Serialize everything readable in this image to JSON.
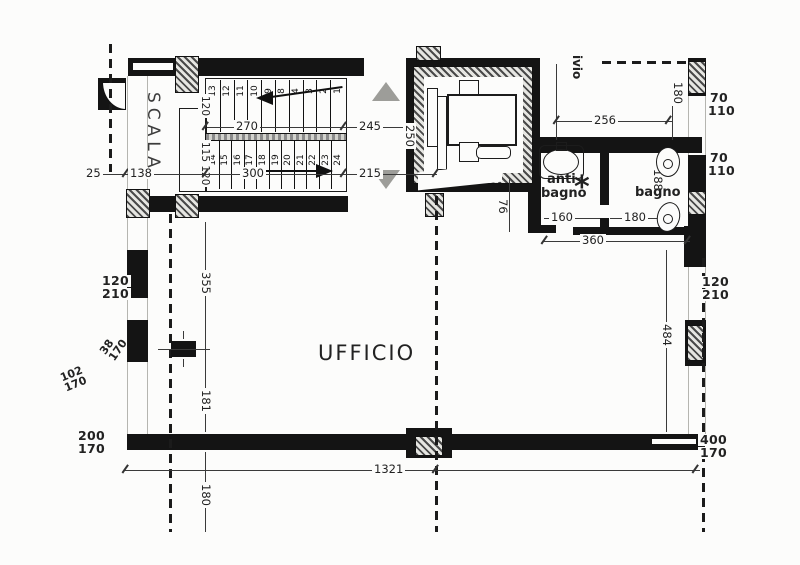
{
  "plan": {
    "rooms": {
      "scala": "SCALA",
      "ufficio": "UFFICIO",
      "anti_bagno_line1": "anti",
      "anti_bagno_line2": "bagno",
      "bagno": "bagno",
      "archivio_partial": "ivio"
    },
    "symbols": {
      "light_point_star": "*"
    },
    "stairs": {
      "upper_treads": [
        "13",
        "12",
        "11",
        "10",
        "9",
        "8",
        "4",
        "3",
        "2",
        "1"
      ],
      "lower_treads": [
        "14",
        "15",
        "16",
        "17",
        "18",
        "19",
        "20",
        "21",
        "22",
        "23",
        "24"
      ],
      "upper_flight_width": "120",
      "lower_flight_width": "115 120",
      "upper_run_length": "270",
      "lower_run_length": "300"
    },
    "dimensions": {
      "entry_25": "25",
      "entry_138": "138",
      "corridor_245": "245",
      "corridor_height_250": "250",
      "corridor_215": "215",
      "top_room_width_256": "256",
      "door_height_180": "180",
      "window_top_width_70": "70",
      "window_top_height_110": "110",
      "window_mid_width_70": "70",
      "window_mid_height_110": "110",
      "anti_bagno_160": "160",
      "bagno_180": "180",
      "bagno_depth_188": "188",
      "bath_total_360": "360",
      "right_window_120": "120",
      "right_window_210": "210",
      "right_wall_484": "484",
      "left_window_120": "120",
      "left_window_210": "210",
      "left_wall_355": "355",
      "left_sill_38": "38",
      "left_sill_170": "170",
      "left_low_102": "102",
      "left_low_170": "170",
      "left_pier_181": "181",
      "bottom_left_200": "200",
      "bottom_left_170": "170",
      "total_width_1321": "1321",
      "bottom_pier_180": "180",
      "bottom_right_400": "400",
      "bottom_right_170": "170",
      "lift_landing_76": "76"
    }
  }
}
